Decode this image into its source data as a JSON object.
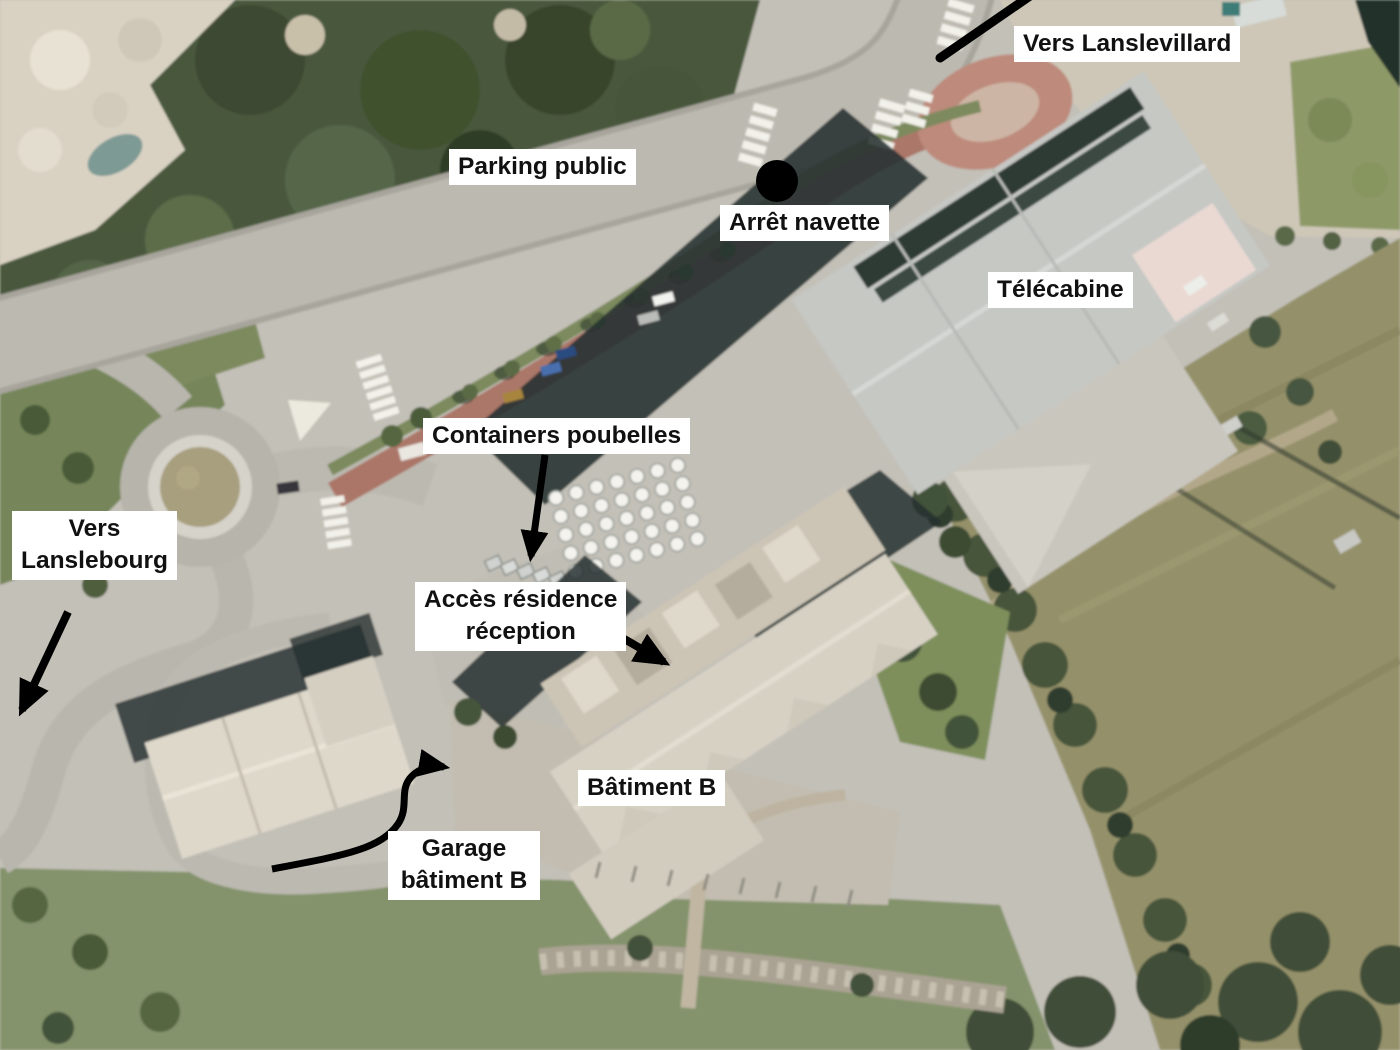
{
  "labels": {
    "vers_lanslevillard": "Vers Lanslevillard",
    "parking_public": "Parking public",
    "arret_navette": "Arrêt navette",
    "telecabine": "Télécabine",
    "containers_poubelles": "Containers poubelles",
    "vers_lanslebourg_line1": "Vers",
    "vers_lanslebourg_line2": "Lanslebourg",
    "acces_residence_line1": "Accès résidence",
    "acces_residence_line2": "réception",
    "batiment_b": "Bâtiment B",
    "garage_line1": "Garage",
    "garage_line2": "bâtiment B"
  },
  "colors": {
    "label_background": "#ffffff",
    "label_text": "#111111",
    "annotation_black": "#000000",
    "red_lane": "#a86f60"
  }
}
